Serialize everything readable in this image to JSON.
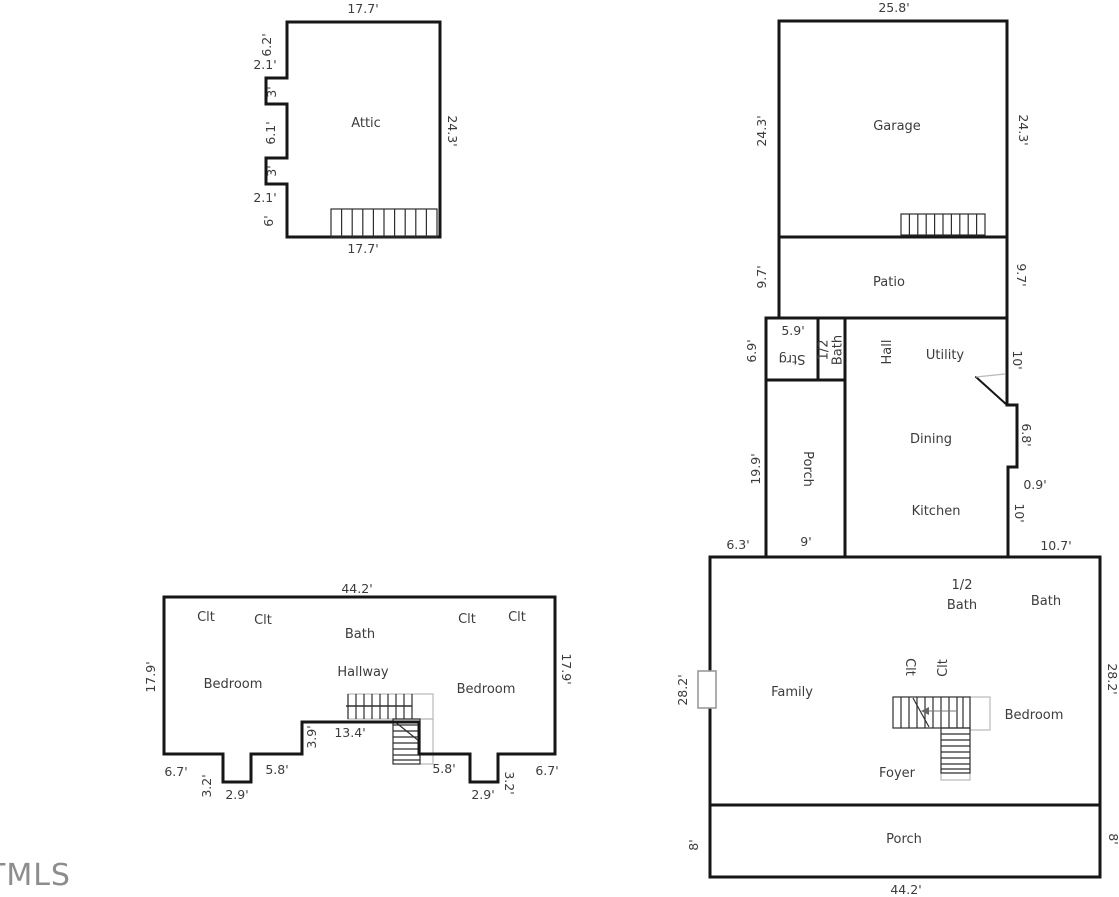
{
  "watermark": "TMLS",
  "attic": {
    "title": "Attic",
    "dim_top": "17.7'",
    "dim_bottom": "17.7'",
    "dim_right": "24.3'",
    "left_dims": {
      "a": "6.2'",
      "b": "2.1'",
      "c": "3'",
      "d": "6.1'",
      "e": "3'",
      "f": "2.1'",
      "g": "6'"
    }
  },
  "garage_floor": {
    "garage": "Garage",
    "patio": "Patio",
    "dim_top": "25.8'",
    "dim_left": "24.3'",
    "dim_right": "24.3'",
    "patio_left": "9.7'",
    "patio_right": "9.7'"
  },
  "main_floor": {
    "strg": "Strg",
    "strg_top": "5.9'",
    "strg_left": "6.9'",
    "half_bath_line1": "1/2",
    "half_bath_line2": "Bath",
    "hall": "Hall",
    "utility": "Utility",
    "utility_right": "10'",
    "dining": "Dining",
    "dining_right": "6.8'",
    "step_dim": "0.9'",
    "kitchen": "Kitchen",
    "kitchen_right": "10'",
    "kitchen_bottom": "10.7'",
    "porch": "Porch",
    "porch_left": "19.9'",
    "porch_bottom": "9'",
    "top_left_dim": "6.3'"
  },
  "family_floor": {
    "half_bath_line1": "1/2",
    "half_bath_line2": "Bath",
    "bath": "Bath",
    "family": "Family",
    "clt1": "Clt",
    "clt2": "Clt",
    "bedroom": "Bedroom",
    "foyer": "Foyer",
    "porch": "Porch",
    "dim_bottom": "44.2'",
    "dim_left": "28.2'",
    "dim_right": "28.2'",
    "porch_left": "8'",
    "porch_right": "8'"
  },
  "second_floor": {
    "dim_top": "44.2'",
    "dim_left": "17.9'",
    "dim_right": "17.9'",
    "clt1": "Clt",
    "clt2": "Clt",
    "clt3": "Clt",
    "clt4": "Clt",
    "bath": "Bath",
    "hallway": "Hallway",
    "bedroom_left": "Bedroom",
    "bedroom_right": "Bedroom",
    "recess_width": "13.4'",
    "recess_height": "3.9'",
    "bottom_dims": {
      "left_67": "6.7'",
      "left_32": "3.2'",
      "left_29": "2.9'",
      "left_58": "5.8'",
      "right_58": "5.8'",
      "right_29": "2.9'",
      "right_32": "3.2'",
      "right_67": "6.7'"
    }
  }
}
